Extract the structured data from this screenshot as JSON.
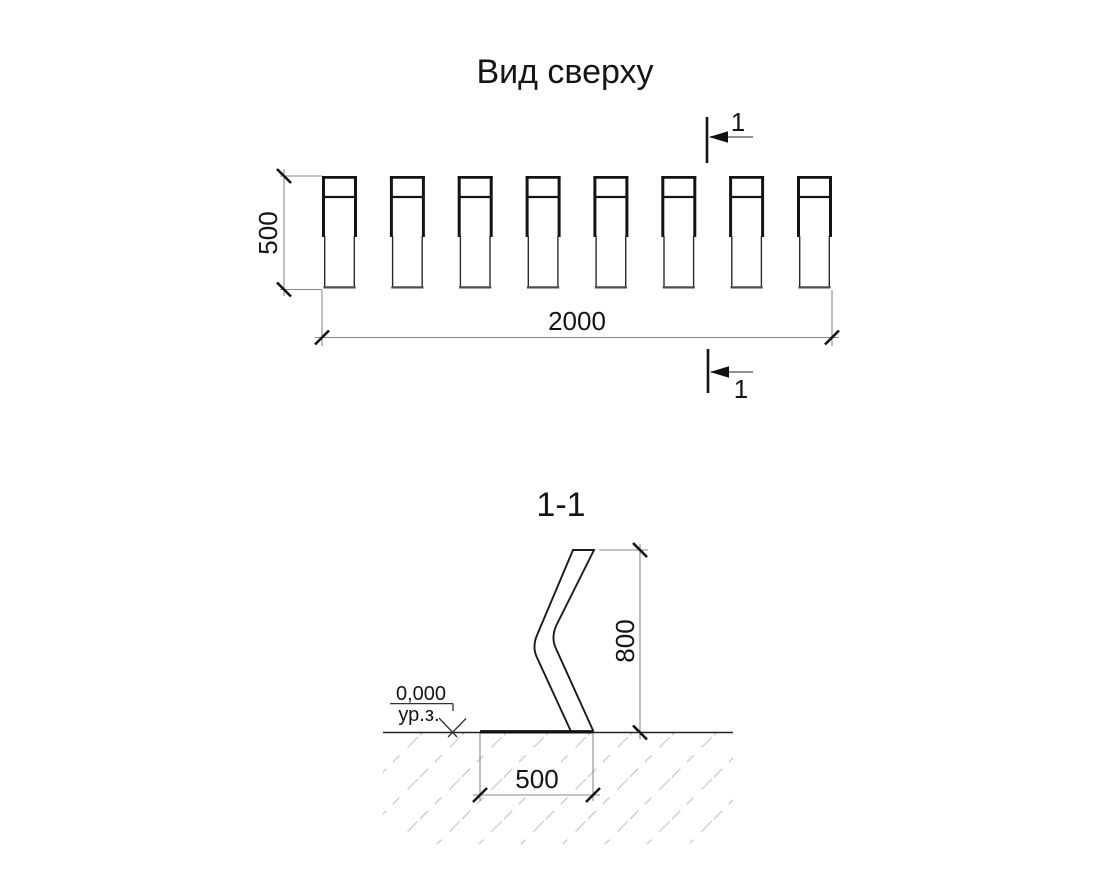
{
  "drawing": {
    "top_view": {
      "title": "Вид сверху",
      "rack_count": 8,
      "dim_height": {
        "value": "500"
      },
      "dim_width": {
        "value": "2000"
      },
      "section_marker": {
        "label": "1"
      }
    },
    "section_view": {
      "title": "1-1",
      "dim_height": {
        "value": "800"
      },
      "dim_foundation": {
        "value": "500"
      },
      "level_mark": {
        "elevation": "0,000",
        "ground_label": "ур.з."
      }
    },
    "colors": {
      "line_main": "#1b1b1b",
      "line_dimension": "#8a8a8a",
      "hatch": "#c5c5c5",
      "background": "#ffffff"
    }
  }
}
